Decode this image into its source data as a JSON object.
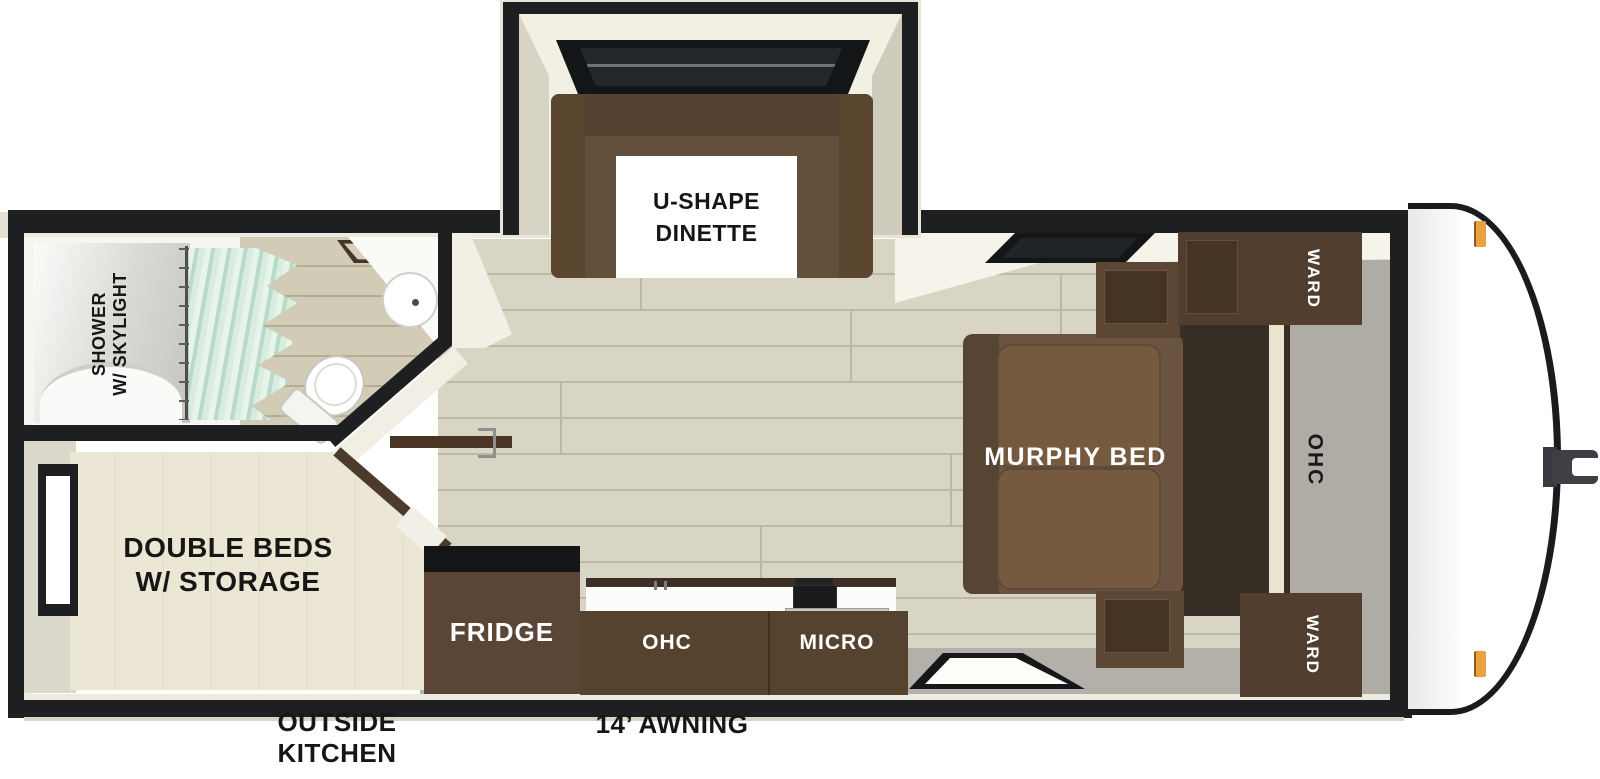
{
  "title": "Travel trailer floor plan (top-down view)",
  "rooms": {
    "dinette": {
      "line1": "U-SHAPE",
      "line2": "DINETTE"
    },
    "bathroom": {
      "shower_line1": "SHOWER",
      "shower_line2": "W/ SKYLIGHT"
    },
    "bedroom": {
      "line1": "DOUBLE BEDS",
      "line2": "W/ STORAGE"
    },
    "living": {
      "murphy_bed": "MURPHY BED",
      "ward_top": "WARD",
      "ward_bottom": "WARD",
      "ohc": "OHC"
    },
    "kitchen": {
      "fridge": "FRIDGE",
      "ohc": "OHC",
      "micro": "MICRO"
    }
  },
  "exterior": {
    "outside_kitchen_line1": "OUTSIDE",
    "outside_kitchen_line2": "KITCHEN",
    "awning": "14’ AWNING"
  },
  "colors": {
    "wall": "#1d1f20",
    "wood_floor": "#d9d5c5",
    "vinyl_gray": "#aeaca4",
    "cabinet_brown": "#56432f",
    "sofa_brown": "#6a5340",
    "bedspread_cream": "#ebe7d4",
    "curtain_mint": "#cfe7da",
    "marker_light_orange": "#e8a23e",
    "label_black": "#161616",
    "label_white": "#ffffff"
  }
}
